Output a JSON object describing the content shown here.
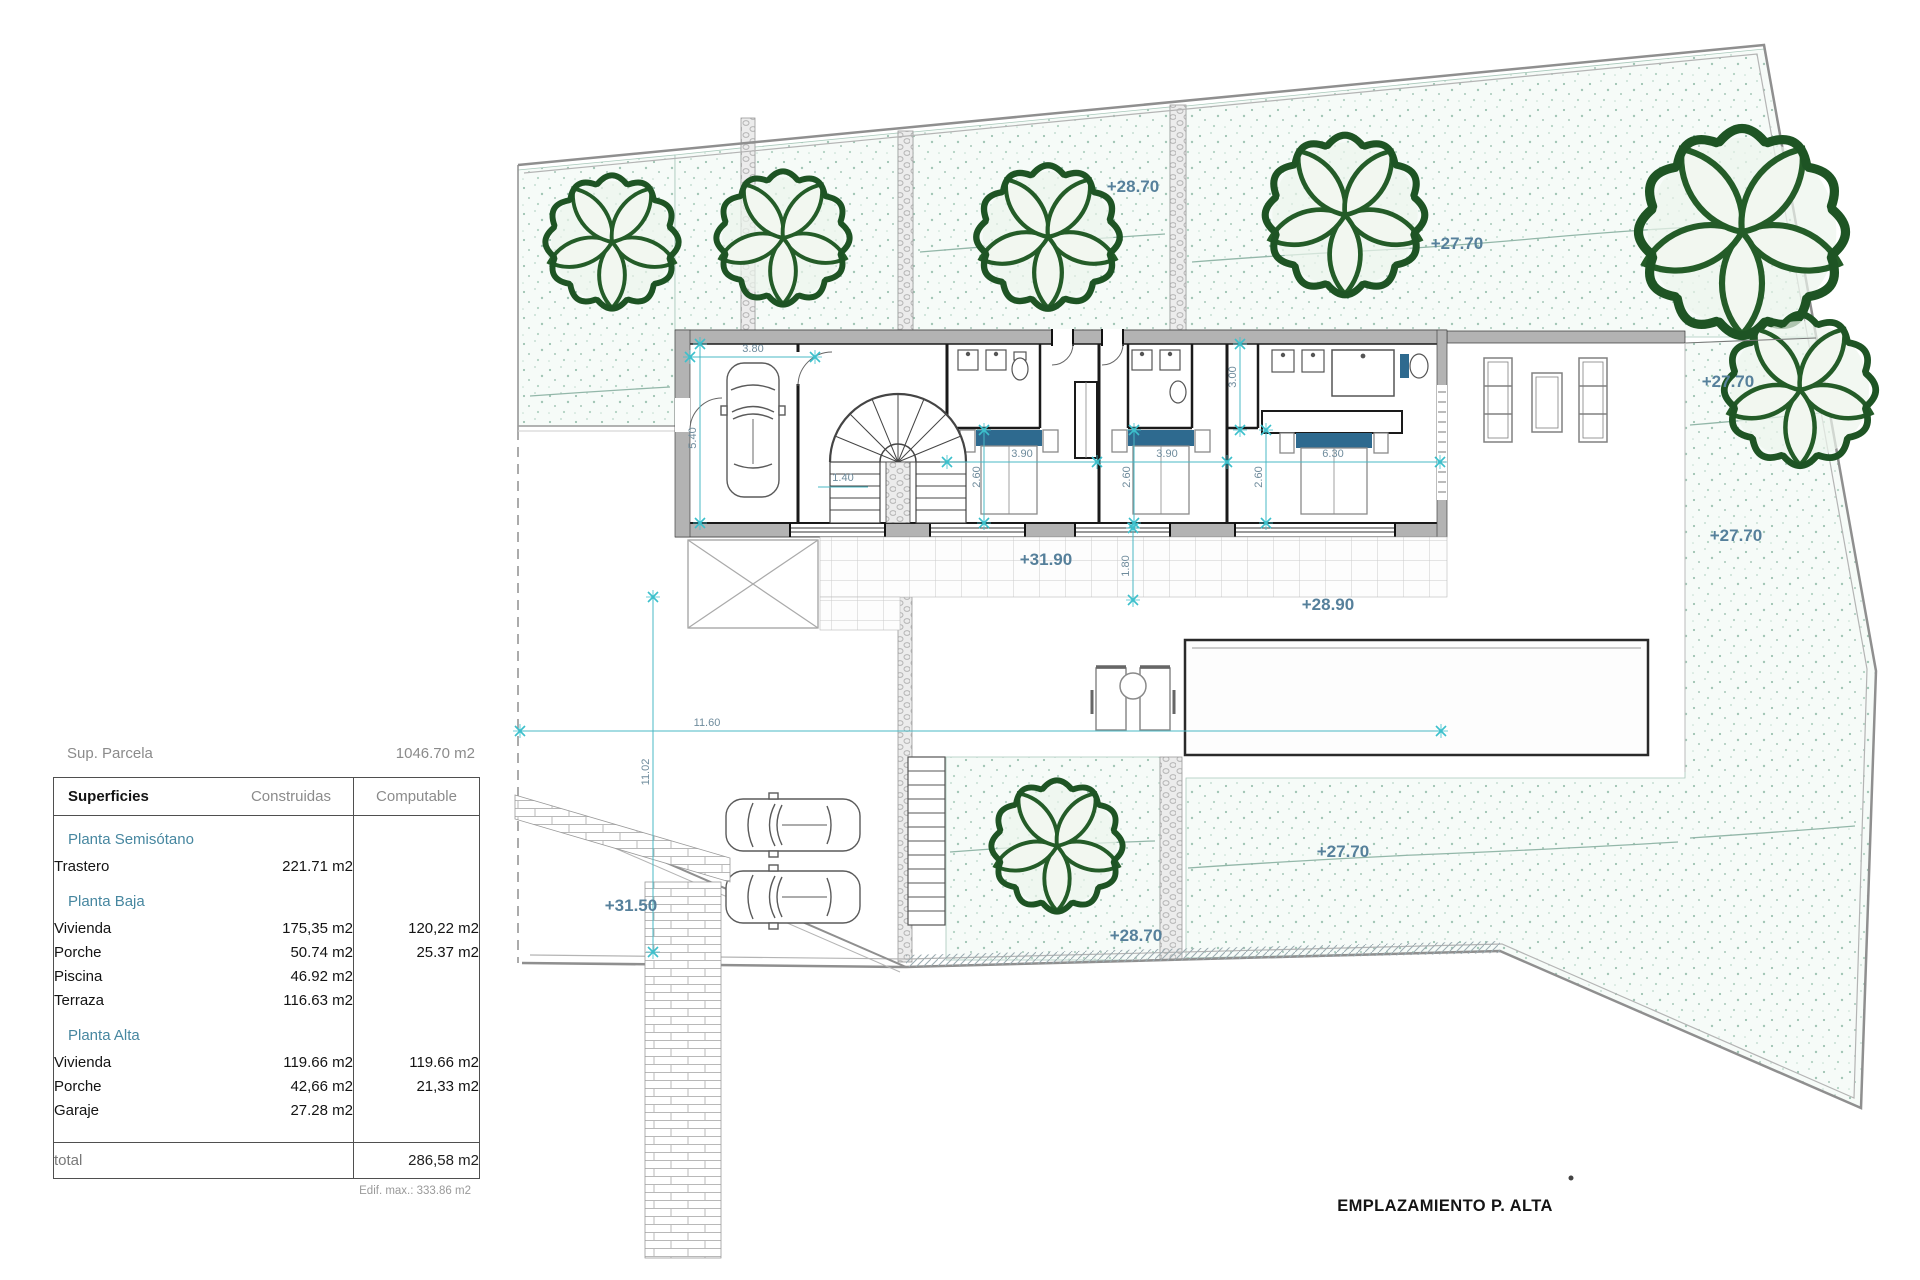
{
  "summary": {
    "parcel_label": "Sup. Parcela",
    "parcel_value": "1046.70 m2",
    "edif_max_label": "Edif. max.: 333.86 m2"
  },
  "table": {
    "headers": [
      "Superficies",
      "Construidas",
      "Computable"
    ],
    "sections": [
      {
        "title": "Planta Semisótano",
        "rows": [
          {
            "name": "Trastero",
            "construidas": "221.71 m2",
            "computable": ""
          }
        ]
      },
      {
        "title": "Planta Baja",
        "rows": [
          {
            "name": "Vivienda",
            "construidas": "175,35 m2",
            "computable": "120,22 m2"
          },
          {
            "name": "Porche",
            "construidas": "50.74 m2",
            "computable": "25.37 m2"
          },
          {
            "name": "Piscina",
            "construidas": "46.92 m2",
            "computable": ""
          },
          {
            "name": "Terraza",
            "construidas": "116.63 m2",
            "computable": ""
          }
        ]
      },
      {
        "title": "Planta Alta",
        "rows": [
          {
            "name": "Vivienda",
            "construidas": "119.66 m2",
            "computable": "119.66 m2"
          },
          {
            "name": "Porche",
            "construidas": "42,66 m2",
            "computable": "21,33 m2"
          },
          {
            "name": "Garaje",
            "construidas": "27.28 m2",
            "computable": ""
          }
        ]
      }
    ],
    "total_label": "total",
    "total_value": "286,58 m2"
  },
  "plan": {
    "caption": "EMPLAZAMIENTO P. ALTA",
    "colors": {
      "accent_teal": "#49b8c4",
      "elevation_text": "#56809b",
      "garden_green": "#245c28",
      "wall_gray": "#b3b3b3",
      "bed_accent": "#2e6a8f"
    },
    "elevations": [
      "+28.70",
      "+27.70",
      "+27.70",
      "+27.70",
      "+31.90",
      "+28.90",
      "+31.50",
      "+28.70",
      "+27.70"
    ],
    "dimensions": [
      "3.80",
      "5.40",
      "1.40",
      "3.90",
      "3.90",
      "6.30",
      "2.60",
      "2.60",
      "2.60",
      "3.00",
      "1.80",
      "11.60",
      "11.02"
    ]
  }
}
